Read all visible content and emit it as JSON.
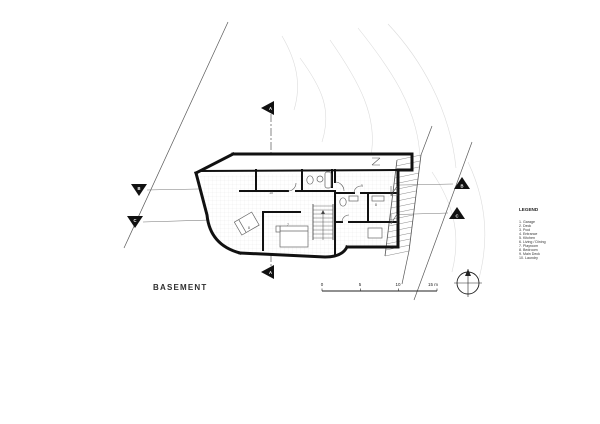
{
  "drawing": {
    "title": "BASEMENT"
  },
  "legend": {
    "title": "LEGEND",
    "items": [
      "1. Garage",
      "2. Deck",
      "3. Pool",
      "4. Entrance",
      "5. Kitchen",
      "6. Living / Dining",
      "7. Playroom",
      "8. Bedroom",
      "9. Main Deck",
      "10. Laundry"
    ]
  },
  "scale_bar": {
    "labels": [
      "0",
      "5",
      "10",
      "15 m"
    ]
  },
  "section_markers": {
    "a": "A",
    "b": "B",
    "c": "C"
  },
  "room_labels": [
    "10",
    "8",
    "7",
    "9",
    "8"
  ],
  "colors": {
    "ink": "#1a1a1a",
    "thin_line": "#555555",
    "contour": "#d9d9d9",
    "paper": "#ffffff"
  }
}
